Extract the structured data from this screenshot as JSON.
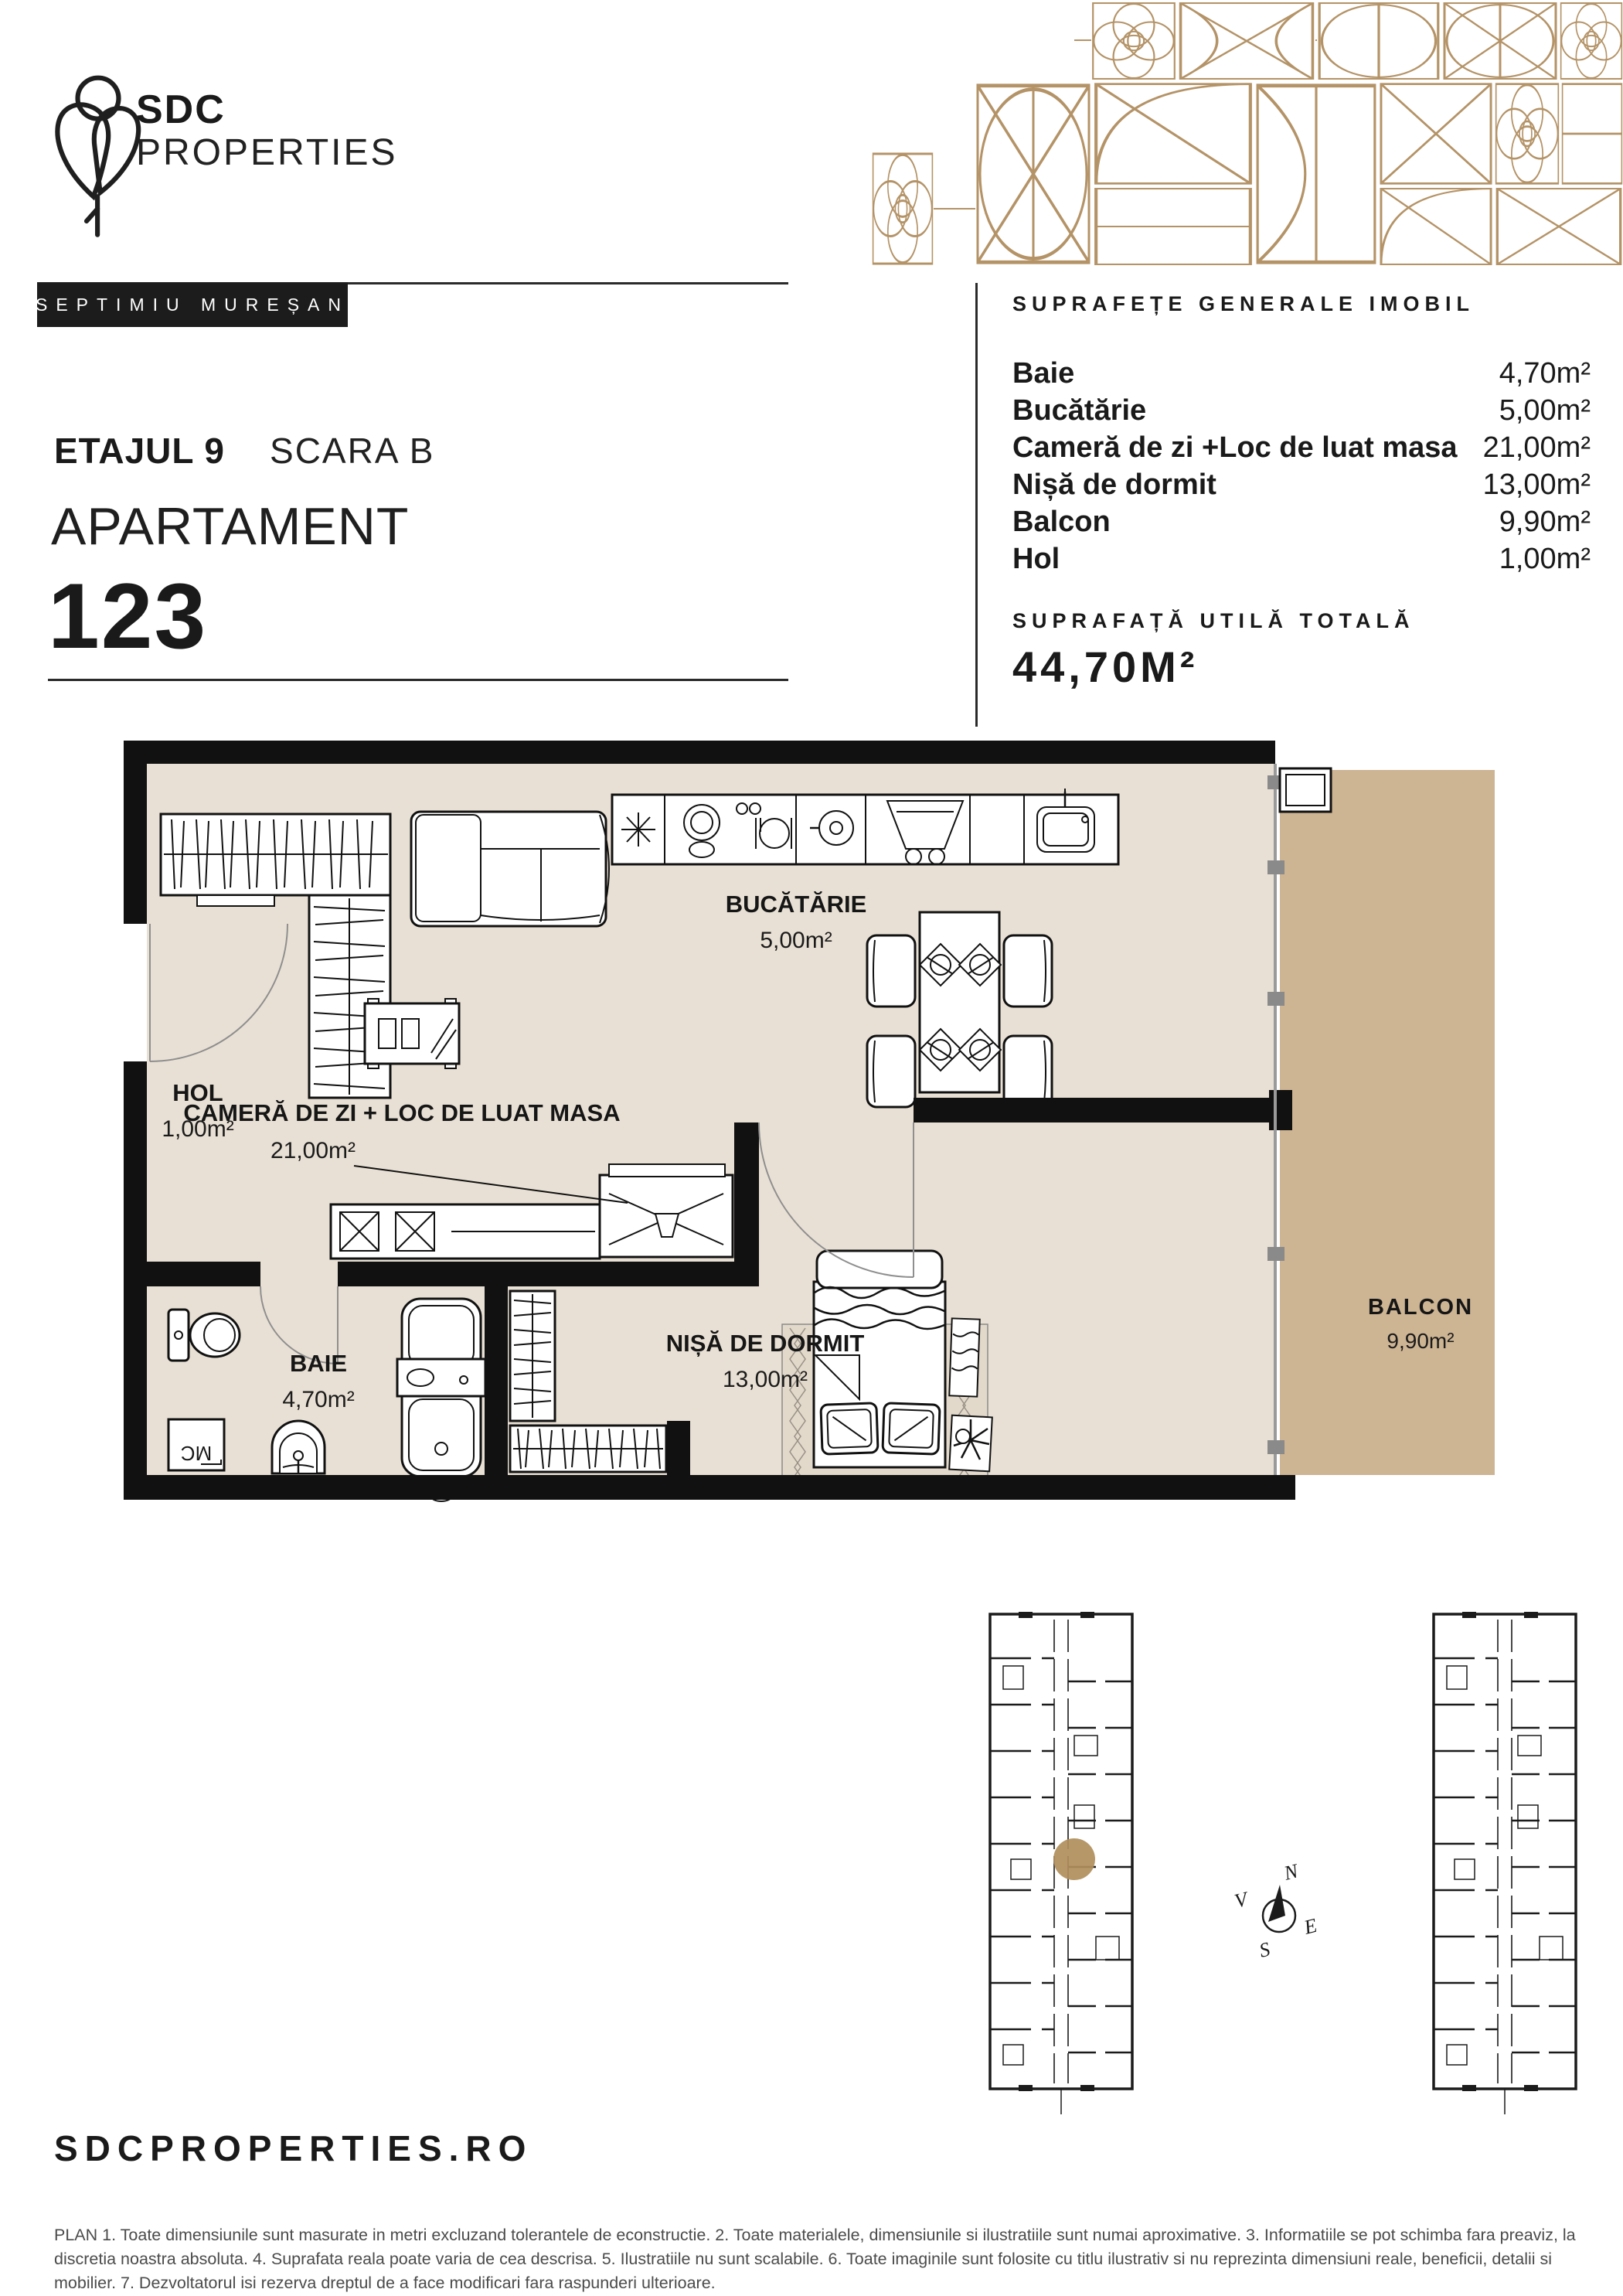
{
  "brand": {
    "name_line1": "SDC",
    "name_line2": "PROPERTIES",
    "agent_name": "SEPTIMIU MUREȘAN"
  },
  "title_block": {
    "floor": "ETAJUL 9",
    "staircase": "SCARA B",
    "unit_type": "APARTAMENT",
    "unit_number": "123"
  },
  "surface_table": {
    "title": "SUPRAFEȚE GENERALE IMOBIL",
    "rows": [
      {
        "label": "Baie",
        "value": "4,70m²"
      },
      {
        "label": "Bucătărie",
        "value": "5,00m²"
      },
      {
        "label": "Cameră de zi +Loc de luat masa",
        "value": "21,00m²"
      },
      {
        "label": "Nișă de dormit",
        "value": "13,00m²"
      },
      {
        "label": "Balcon",
        "value": "9,90m²"
      },
      {
        "label": "Hol",
        "value": "1,00m²"
      }
    ],
    "total_title": "SUPRAFAȚĂ UTILĂ TOTALĂ",
    "total_value": "44,70M²"
  },
  "floor_plan": {
    "rooms": {
      "kitchen": {
        "name": "BUCĂTĂRIE",
        "area": "5,00m²"
      },
      "living": {
        "name": "CAMERĂ DE ZI  + LOC DE LUAT MASA",
        "area": "21,00m²"
      },
      "hall": {
        "name": "HOL",
        "area": "1,00m²"
      },
      "sleeping": {
        "name": "NIȘĂ DE DORMIT",
        "area": "13,00m²"
      },
      "bathroom": {
        "name": "BAIE",
        "area": "4,70m²"
      },
      "balcony": {
        "name": "BALCON",
        "area": "9,90m²"
      },
      "washing_machine_label": "MC"
    },
    "colors": {
      "interior": "#E8E0D4",
      "balcony": "#CDB493",
      "wall": "#111111",
      "glass": "#9A9A9A",
      "accent_gold": "#B49367"
    }
  },
  "site_plan": {
    "compass": {
      "north": "N",
      "south": "S",
      "east": "E",
      "west": "V"
    }
  },
  "footer": {
    "website": "SDCPROPERTIES.RO",
    "disclaimer": "PLAN 1. Toate dimensiunile sunt masurate in metri excluzand tolerantele de econstructie. 2. Toate materialele, dimensiunile si ilustratiile sunt numai aproximative. 3. Informatiile se pot schimba fara preaviz, la discretia noastra absoluta. 4. Suprafata reala poate varia de cea descrisa. 5. Ilustratiile nu sunt scalabile. 6. Toate imaginile sunt folosite cu titlu ilustrativ si nu reprezinta dimensiuni reale, beneficii, detalii si mobilier. 7. Dezvoltatorul isi rezerva dreptul de a face modificari fara raspunderi ulterioare."
  }
}
